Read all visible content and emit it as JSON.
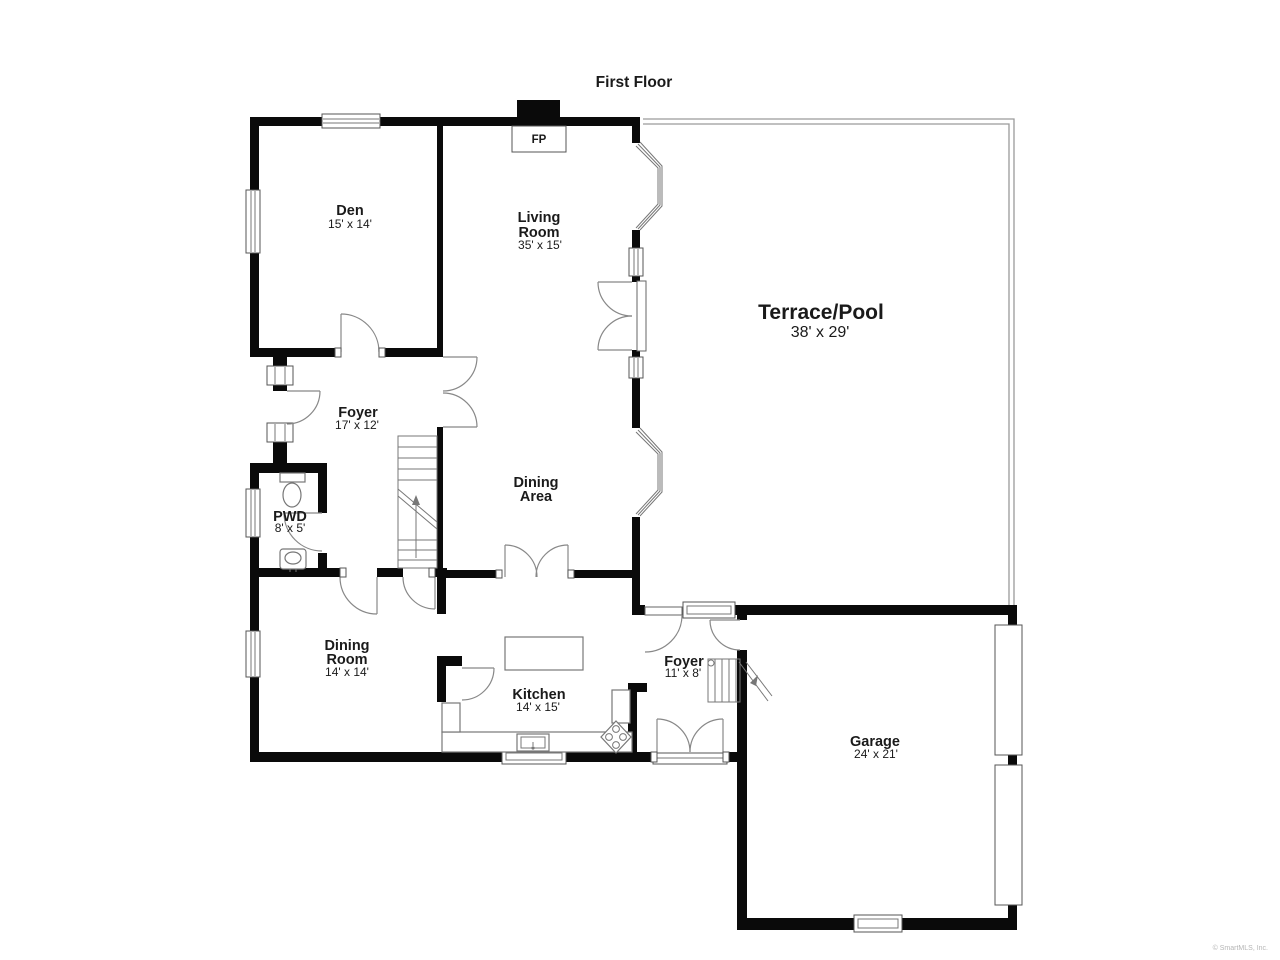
{
  "title": "First Floor",
  "watermark": "© SmartMLS, Inc.",
  "fireplace": {
    "label": "FP"
  },
  "colors": {
    "wall": "#0a0a0a",
    "line": "#777777",
    "terrace_outline": "#9a9a9a",
    "text": "#1a1a1a",
    "watermark": "#b5b5b5"
  },
  "rooms": {
    "den": {
      "name": "Den",
      "dims": "15' x 14'"
    },
    "living_room": {
      "line1": "Living",
      "line2": "Room",
      "dims": "35' x 15'"
    },
    "terrace_pool": {
      "name": "Terrace/Pool",
      "dims": "38' x 29'"
    },
    "foyer_main": {
      "name": "Foyer",
      "dims": "17' x 12'"
    },
    "pwd": {
      "name": "PWD",
      "dims": "8' x 5'"
    },
    "dining_area": {
      "line1": "Dining",
      "line2": "Area"
    },
    "dining_room": {
      "line1": "Dining",
      "line2": "Room",
      "dims": "14' x 14'"
    },
    "kitchen": {
      "name": "Kitchen",
      "dims": "14' x 15'"
    },
    "foyer_rear": {
      "name": "Foyer",
      "dims": "11' x 8'"
    },
    "garage": {
      "name": "Garage",
      "dims": "24' x 21'"
    }
  }
}
